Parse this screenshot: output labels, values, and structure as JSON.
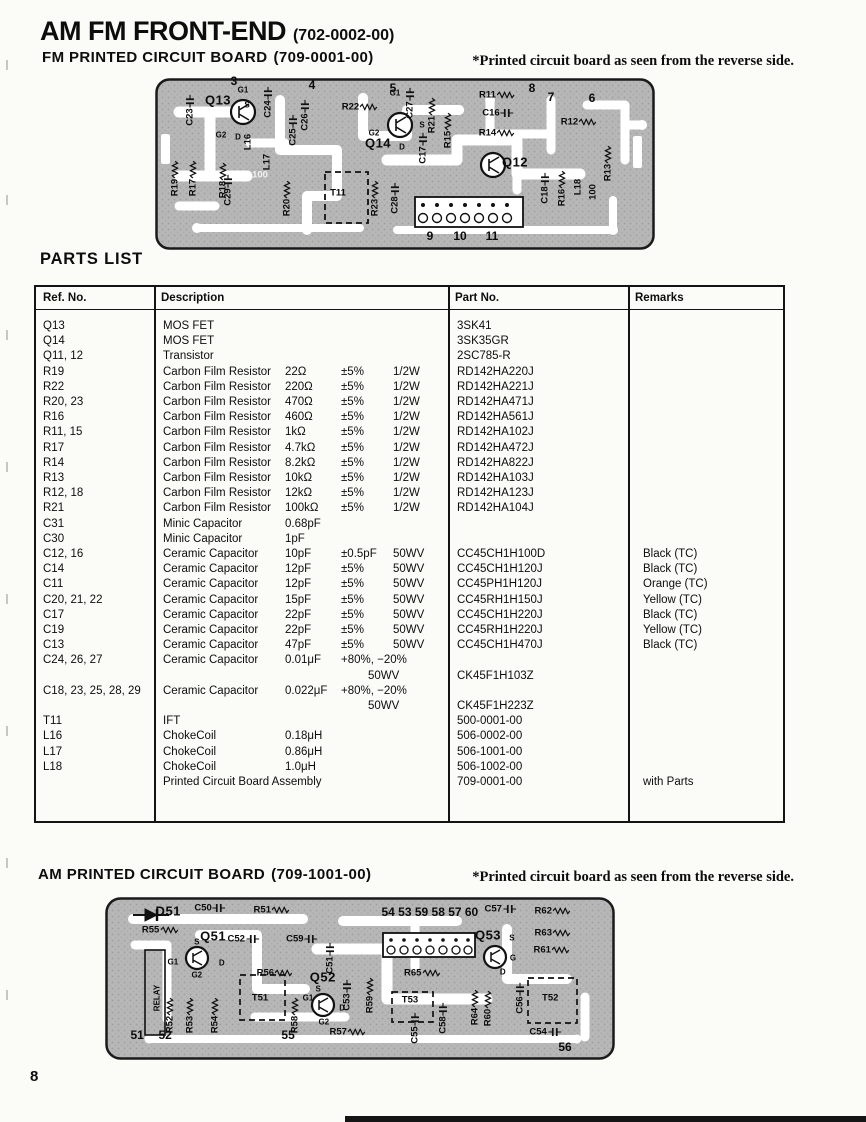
{
  "page": {
    "number": "8"
  },
  "fm_section": {
    "title": "AM FM FRONT-END",
    "title_code": "(702-0002-00)",
    "subtitle": "FM  PRINTED CIRCUIT BOARD",
    "subtitle_code": "(709-0001-00)",
    "note": "*Printed circuit board as seen from the reverse side."
  },
  "am_section": {
    "title": "AM  PRINTED CIRCUIT BOARD",
    "title_code": "(709-1001-00)",
    "note": "*Printed circuit board as seen from the reverse side."
  },
  "parts_list": {
    "heading": "PARTS LIST",
    "columns": [
      "Ref. No.",
      "Description",
      "Part No.",
      "Remarks"
    ],
    "rows": [
      {
        "ref": "Q13",
        "d": [
          "MOS FET",
          "",
          "",
          ""
        ],
        "part": "3SK41",
        "rem": ""
      },
      {
        "ref": "Q14",
        "d": [
          "MOS FET",
          "",
          "",
          ""
        ],
        "part": "3SK35GR",
        "rem": ""
      },
      {
        "ref": "Q11, 12",
        "d": [
          "Transistor",
          "",
          "",
          ""
        ],
        "part": "2SC785-R",
        "rem": ""
      },
      {
        "ref": "R19",
        "d": [
          "Carbon Film Resistor",
          "22Ω",
          "±5%",
          "1/2W"
        ],
        "part": "RD142HA220J",
        "rem": ""
      },
      {
        "ref": "R22",
        "d": [
          "Carbon Film Resistor",
          "220Ω",
          "±5%",
          "1/2W"
        ],
        "part": "RD142HA221J",
        "rem": ""
      },
      {
        "ref": "R20, 23",
        "d": [
          "Carbon Film Resistor",
          "470Ω",
          "±5%",
          "1/2W"
        ],
        "part": "RD142HA471J",
        "rem": ""
      },
      {
        "ref": "R16",
        "d": [
          "Carbon Film Resistor",
          "460Ω",
          "±5%",
          "1/2W"
        ],
        "part": "RD142HA561J",
        "rem": ""
      },
      {
        "ref": "R11, 15",
        "d": [
          "Carbon Film Resistor",
          "1kΩ",
          "±5%",
          "1/2W"
        ],
        "part": "RD142HA102J",
        "rem": ""
      },
      {
        "ref": "R17",
        "d": [
          "Carbon Film Resistor",
          "4.7kΩ",
          "±5%",
          "1/2W"
        ],
        "part": "RD142HA472J",
        "rem": ""
      },
      {
        "ref": "R14",
        "d": [
          "Carbon Film Resistor",
          "8.2kΩ",
          "±5%",
          "1/2W"
        ],
        "part": "RD142HA822J",
        "rem": ""
      },
      {
        "ref": "R13",
        "d": [
          "Carbon Film Resistor",
          "10kΩ",
          "±5%",
          "1/2W"
        ],
        "part": "RD142HA103J",
        "rem": ""
      },
      {
        "ref": "R12, 18",
        "d": [
          "Carbon Film Resistor",
          "12kΩ",
          "±5%",
          "1/2W"
        ],
        "part": "RD142HA123J",
        "rem": ""
      },
      {
        "ref": "R21",
        "d": [
          "Carbon Film Resistor",
          "100kΩ",
          "±5%",
          "1/2W"
        ],
        "part": "RD142HA104J",
        "rem": ""
      },
      {
        "ref": "C31",
        "d": [
          "Minic Capacitor",
          "0.68pF",
          "",
          ""
        ],
        "part": "",
        "rem": ""
      },
      {
        "ref": "C30",
        "d": [
          "Minic Capacitor",
          "1pF",
          "",
          ""
        ],
        "part": "",
        "rem": ""
      },
      {
        "ref": "C12, 16",
        "d": [
          "Ceramic Capacitor",
          "10pF",
          "±0.5pF",
          "50WV"
        ],
        "part": "CC45CH1H100D",
        "rem": "Black (TC)"
      },
      {
        "ref": "C14",
        "d": [
          "Ceramic Capacitor",
          "12pF",
          "±5%",
          "50WV"
        ],
        "part": "CC45CH1H120J",
        "rem": "Black (TC)"
      },
      {
        "ref": "C11",
        "d": [
          "Ceramic Capacitor",
          "12pF",
          "±5%",
          "50WV"
        ],
        "part": "CC45PH1H120J",
        "rem": "Orange (TC)"
      },
      {
        "ref": "C20, 21, 22",
        "d": [
          "Ceramic Capacitor",
          "15pF",
          "±5%",
          "50WV"
        ],
        "part": "CC45RH1H150J",
        "rem": "Yellow (TC)"
      },
      {
        "ref": "C17",
        "d": [
          "Ceramic Capacitor",
          "22pF",
          "±5%",
          "50WV"
        ],
        "part": "CC45CH1H220J",
        "rem": "Black (TC)"
      },
      {
        "ref": "C19",
        "d": [
          "Ceramic Capacitor",
          "22pF",
          "±5%",
          "50WV"
        ],
        "part": "CC45RH1H220J",
        "rem": "Yellow (TC)"
      },
      {
        "ref": "C13",
        "d": [
          "Ceramic Capacitor",
          "47pF",
          "±5%",
          "50WV"
        ],
        "part": "CC45CH1H470J",
        "rem": "Black (TC)"
      },
      {
        "ref": "C24, 26, 27",
        "d": [
          "Ceramic Capacitor",
          "0.01μF",
          "+80%, −20%",
          ""
        ],
        "d2": "50WV",
        "part": "CK45F1H103Z",
        "rem": ""
      },
      {
        "ref": "C18, 23, 25, 28, 29",
        "d": [
          "Ceramic Capacitor",
          "0.022μF",
          "+80%, −20%",
          ""
        ],
        "d2": "50WV",
        "part": "CK45F1H223Z",
        "rem": ""
      },
      {
        "ref": "T11",
        "d": [
          "IFT",
          "",
          "",
          ""
        ],
        "part": "500-0001-00",
        "rem": ""
      },
      {
        "ref": "L16",
        "d": [
          "ChokeCoil",
          "0.18μH",
          "",
          ""
        ],
        "part": "506-0002-00",
        "rem": ""
      },
      {
        "ref": "L17",
        "d": [
          "ChokeCoil",
          "0.86μH",
          "",
          ""
        ],
        "part": "506-1001-00",
        "rem": ""
      },
      {
        "ref": "L18",
        "d": [
          "ChokeCoil",
          "1.0μH",
          "",
          ""
        ],
        "part": "506-1002-00",
        "rem": ""
      },
      {
        "ref": "",
        "d": [
          "Printed Circuit Board Assembly",
          "",
          "",
          ""
        ],
        "part": "709-0001-00",
        "rem": "with Parts"
      }
    ]
  },
  "fm_board": {
    "board_color": "#b7b7b7",
    "trace_color": "#ffffff",
    "labels": [
      {
        "t": "3",
        "x": 15.8,
        "y": 1.5,
        "c": "num"
      },
      {
        "t": "4",
        "x": 31.4,
        "y": 4.1,
        "c": "num"
      },
      {
        "t": "5",
        "x": 47.6,
        "y": 5.8,
        "c": "num"
      },
      {
        "t": "8",
        "x": 75.4,
        "y": 5.8,
        "c": "num"
      },
      {
        "t": "7",
        "x": 79.2,
        "y": 11.0,
        "c": "num"
      },
      {
        "t": "6",
        "x": 87.4,
        "y": 11.6,
        "c": "num"
      },
      {
        "t": "9",
        "x": 55.0,
        "y": 92.0,
        "c": "num"
      },
      {
        "t": "10",
        "x": 61.0,
        "y": 92.0,
        "c": "num"
      },
      {
        "t": "11",
        "x": 67.4,
        "y": 92.0,
        "c": "num"
      },
      {
        "t": "Q13",
        "x": 12.6,
        "y": 12.8,
        "c": "big"
      },
      {
        "t": "Q14",
        "x": 44.6,
        "y": 37.8,
        "c": "big"
      },
      {
        "t": "Q12",
        "x": 72.0,
        "y": 48.8,
        "c": "big"
      },
      {
        "t": "G1",
        "x": 17.6,
        "y": 7.0,
        "c": "sm"
      },
      {
        "t": "S",
        "x": 18.4,
        "y": 15.7,
        "c": "sm"
      },
      {
        "t": "G2",
        "x": 13.2,
        "y": 33.1,
        "c": "sm"
      },
      {
        "t": "D",
        "x": 16.6,
        "y": 34.3,
        "c": "sm"
      },
      {
        "t": "G1",
        "x": 48.0,
        "y": 8.7,
        "c": "sm"
      },
      {
        "t": "G2",
        "x": 43.8,
        "y": 32.0,
        "c": "sm"
      },
      {
        "t": "D",
        "x": 49.4,
        "y": 40.1,
        "c": "sm"
      },
      {
        "t": "S",
        "x": 53.4,
        "y": 27.3,
        "c": "sm"
      },
      {
        "t": "R22",
        "x": 41.0,
        "y": 16.9,
        "c": ""
      },
      {
        "t": "R11",
        "x": 68.4,
        "y": 9.9,
        "c": ""
      },
      {
        "t": "C16",
        "x": 68.6,
        "y": 20.3,
        "c": ""
      },
      {
        "t": "R14",
        "x": 68.4,
        "y": 32.0,
        "c": ""
      },
      {
        "t": "R12",
        "x": 84.8,
        "y": 25.6,
        "c": ""
      },
      {
        "t": "T11",
        "x": 36.6,
        "y": 66.9,
        "c": ""
      },
      {
        "t": "C23",
        "x": 7.0,
        "y": 18.6,
        "c": "v"
      },
      {
        "t": "C24",
        "x": 22.6,
        "y": 14.0,
        "c": "v"
      },
      {
        "t": "C26",
        "x": 30.0,
        "y": 21.5,
        "c": "v"
      },
      {
        "t": "C25",
        "x": 27.6,
        "y": 30.2,
        "c": "v"
      },
      {
        "t": "C27",
        "x": 51.0,
        "y": 14.5,
        "c": "v"
      },
      {
        "t": "R21",
        "x": 55.4,
        "y": 21.5,
        "c": "v"
      },
      {
        "t": "R15",
        "x": 58.6,
        "y": 30.2,
        "c": "v"
      },
      {
        "t": "L16",
        "x": 18.6,
        "y": 37.2,
        "c": "v"
      },
      {
        "t": "L17",
        "x": 22.4,
        "y": 48.8,
        "c": "v"
      },
      {
        "t": "R19",
        "x": 4.0,
        "y": 58.1,
        "c": "v"
      },
      {
        "t": "R17",
        "x": 7.6,
        "y": 58.1,
        "c": "v"
      },
      {
        "t": "R18",
        "x": 13.6,
        "y": 59.3,
        "c": "v"
      },
      {
        "t": "C29",
        "x": 14.6,
        "y": 65.1,
        "c": "v"
      },
      {
        "t": "R20",
        "x": 26.4,
        "y": 69.8,
        "c": "v"
      },
      {
        "t": "R23",
        "x": 44.0,
        "y": 69.8,
        "c": "v"
      },
      {
        "t": "C28",
        "x": 48.0,
        "y": 69.8,
        "c": "v"
      },
      {
        "t": "C17",
        "x": 53.6,
        "y": 40.7,
        "c": "v"
      },
      {
        "t": "C18",
        "x": 78.0,
        "y": 64.0,
        "c": "v"
      },
      {
        "t": "R16",
        "x": 81.4,
        "y": 64.0,
        "c": "v"
      },
      {
        "t": "L18",
        "x": 84.6,
        "y": 63.4,
        "c": "v"
      },
      {
        "t": "R13",
        "x": 90.6,
        "y": 49.4,
        "c": "v"
      },
      {
        "t": "100",
        "x": 87.6,
        "y": 66.3,
        "c": "v"
      },
      {
        "t": "100",
        "x": 21.0,
        "y": 56.5,
        "c": "wht"
      }
    ]
  },
  "am_board": {
    "board_color": "#b7b7b7",
    "trace_color": "#ffffff",
    "pin_numbers": "54 53 59 58 57 60",
    "labels": [
      {
        "t": "D51",
        "x": 12.4,
        "y": 8.6,
        "c": "big"
      },
      {
        "t": "Q51",
        "x": 21.2,
        "y": 23.9,
        "c": "big"
      },
      {
        "t": "Q52",
        "x": 42.7,
        "y": 49.1,
        "c": "big"
      },
      {
        "t": "Q53",
        "x": 75.1,
        "y": 23.3,
        "c": "big"
      },
      {
        "t": "54 53 59 58 57 60",
        "x": 63.7,
        "y": 9.5,
        "c": "num"
      },
      {
        "t": "51",
        "x": 6.3,
        "y": 84.7,
        "c": "num"
      },
      {
        "t": "52",
        "x": 11.8,
        "y": 84.7,
        "c": "num"
      },
      {
        "t": "55",
        "x": 35.9,
        "y": 84.7,
        "c": "num"
      },
      {
        "t": "56",
        "x": 90.2,
        "y": 92.0,
        "c": "num"
      },
      {
        "t": "C50",
        "x": 20.6,
        "y": 6.7,
        "c": ""
      },
      {
        "t": "R51",
        "x": 32.7,
        "y": 8.0,
        "c": ""
      },
      {
        "t": "R55",
        "x": 10.8,
        "y": 20.2,
        "c": ""
      },
      {
        "t": "C52",
        "x": 27.1,
        "y": 25.8,
        "c": ""
      },
      {
        "t": "C59",
        "x": 38.6,
        "y": 25.8,
        "c": ""
      },
      {
        "t": "R56",
        "x": 33.3,
        "y": 46.6,
        "c": ""
      },
      {
        "t": "R65",
        "x": 62.2,
        "y": 46.6,
        "c": ""
      },
      {
        "t": "C57",
        "x": 77.5,
        "y": 7.4,
        "c": ""
      },
      {
        "t": "R62",
        "x": 87.8,
        "y": 8.6,
        "c": ""
      },
      {
        "t": "R63",
        "x": 87.8,
        "y": 22.1,
        "c": ""
      },
      {
        "t": "R61",
        "x": 87.6,
        "y": 32.5,
        "c": ""
      },
      {
        "t": "T51",
        "x": 30.4,
        "y": 62.0,
        "c": ""
      },
      {
        "t": "T53",
        "x": 59.8,
        "y": 63.2,
        "c": ""
      },
      {
        "t": "T52",
        "x": 87.3,
        "y": 62.0,
        "c": ""
      },
      {
        "t": "R57",
        "x": 47.6,
        "y": 82.8,
        "c": ""
      },
      {
        "t": "C54",
        "x": 86.3,
        "y": 82.8,
        "c": ""
      },
      {
        "t": "G1",
        "x": 13.3,
        "y": 39.9,
        "c": "sm"
      },
      {
        "t": "S",
        "x": 18.0,
        "y": 27.6,
        "c": "sm"
      },
      {
        "t": "G2",
        "x": 18.0,
        "y": 47.9,
        "c": "sm"
      },
      {
        "t": "D",
        "x": 22.9,
        "y": 40.5,
        "c": "sm"
      },
      {
        "t": "S",
        "x": 79.8,
        "y": 25.2,
        "c": "sm"
      },
      {
        "t": "G",
        "x": 80.0,
        "y": 37.4,
        "c": "sm"
      },
      {
        "t": "D",
        "x": 78.0,
        "y": 46.0,
        "c": "sm"
      },
      {
        "t": "S",
        "x": 41.8,
        "y": 56.4,
        "c": "sm"
      },
      {
        "t": "G1",
        "x": 39.8,
        "y": 62.0,
        "c": "sm"
      },
      {
        "t": "G2",
        "x": 42.9,
        "y": 76.7,
        "c": "sm"
      },
      {
        "t": "D",
        "x": 46.5,
        "y": 68.1,
        "c": "sm"
      },
      {
        "t": "C51",
        "x": 44.1,
        "y": 37.4,
        "c": "v"
      },
      {
        "t": "RELAY",
        "x": 10.2,
        "y": 62.0,
        "c": "v sm"
      },
      {
        "t": "R52",
        "x": 12.7,
        "y": 72.4,
        "c": "v"
      },
      {
        "t": "R53",
        "x": 16.7,
        "y": 72.4,
        "c": "v"
      },
      {
        "t": "R54",
        "x": 21.6,
        "y": 72.4,
        "c": "v"
      },
      {
        "t": "R58",
        "x": 37.3,
        "y": 72.4,
        "c": "v"
      },
      {
        "t": "C53",
        "x": 47.5,
        "y": 60.1,
        "c": "v"
      },
      {
        "t": "R59",
        "x": 52.0,
        "y": 60.1,
        "c": "v"
      },
      {
        "t": "C55",
        "x": 60.8,
        "y": 80.4,
        "c": "v"
      },
      {
        "t": "C58",
        "x": 66.3,
        "y": 74.2,
        "c": "v"
      },
      {
        "t": "R64",
        "x": 72.5,
        "y": 67.5,
        "c": "v"
      },
      {
        "t": "R60",
        "x": 75.1,
        "y": 68.1,
        "c": "v"
      },
      {
        "t": "C56",
        "x": 81.4,
        "y": 62.0,
        "c": "v"
      }
    ]
  }
}
